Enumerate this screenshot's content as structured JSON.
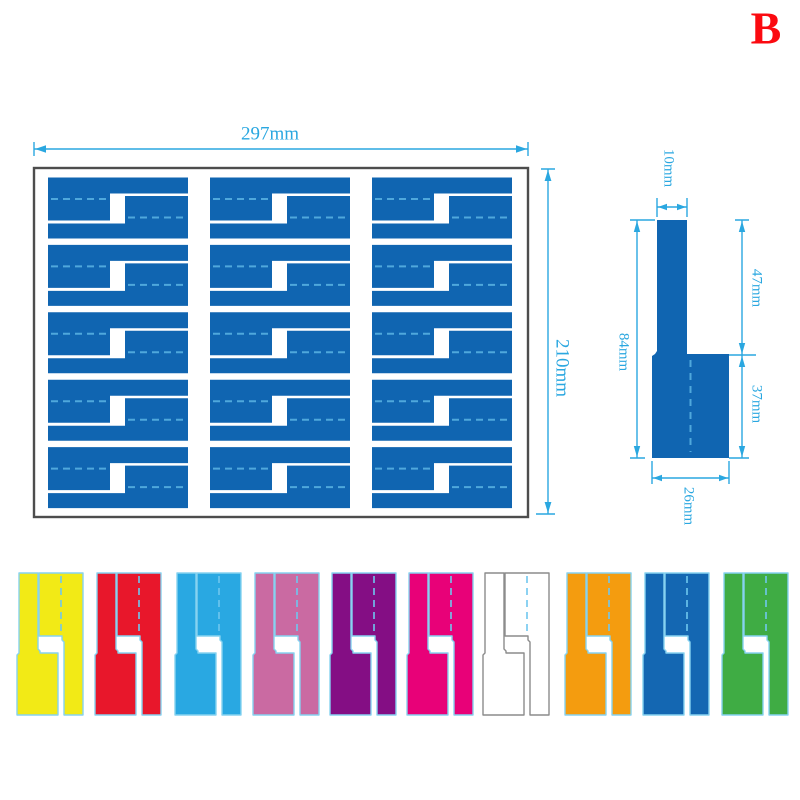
{
  "badge": {
    "label": "B",
    "color": "#fb0a10"
  },
  "sheet": {
    "width_label": "297mm",
    "height_label": "210mm",
    "rows": 5,
    "columns": 3,
    "fill": "#1065b1",
    "dash_color": "#4fa8dc",
    "border_color": "#4d4d4d"
  },
  "single_label": {
    "fill": "#1065b1",
    "dash_color": "#4fa8dc",
    "dims": {
      "stem_width": "10mm",
      "stem_length": "47mm",
      "total_length": "84mm",
      "flag_length": "37mm",
      "flag_width": "26mm"
    }
  },
  "dimension_color": "#2aa7e0",
  "color_samples": {
    "outline": "#86d2f0",
    "white_outline": "#8c8c8c",
    "dash": "#6fc7ee",
    "items": [
      {
        "name": "yellow",
        "hex": "#f2ea16"
      },
      {
        "name": "red",
        "hex": "#e8172b"
      },
      {
        "name": "sky-blue",
        "hex": "#29a8e2"
      },
      {
        "name": "orchid",
        "hex": "#ca6aa2"
      },
      {
        "name": "purple",
        "hex": "#840e84"
      },
      {
        "name": "magenta",
        "hex": "#e80178"
      },
      {
        "name": "white",
        "hex": "#ffffff"
      },
      {
        "name": "orange",
        "hex": "#f49c0f"
      },
      {
        "name": "blue",
        "hex": "#1467b2"
      },
      {
        "name": "green",
        "hex": "#3fac44"
      }
    ]
  }
}
